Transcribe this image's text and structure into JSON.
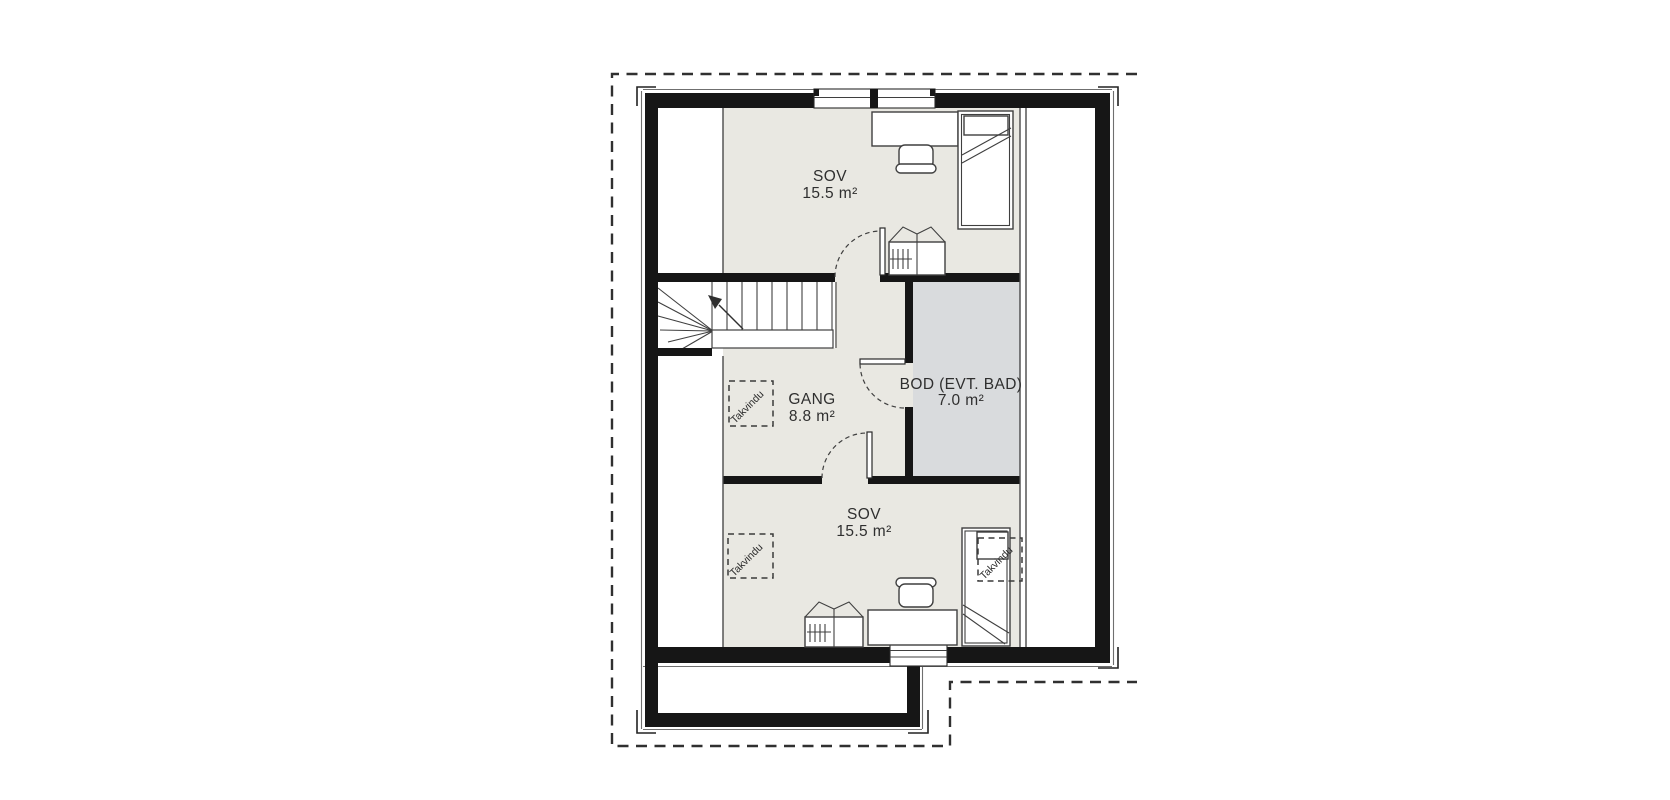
{
  "floorplan": {
    "rooms": [
      {
        "name": "SOV",
        "area": "15.5 m²"
      },
      {
        "name": "GANG",
        "area": "8.8 m²"
      },
      {
        "name": "BOD (EVT. BAD)",
        "area": "7.0 m²"
      },
      {
        "name": "SOV",
        "area": "15.5 m²"
      }
    ],
    "skylight_label": "Takvindu",
    "colors": {
      "wall": "#161616",
      "room_fill": "#e9e8e2",
      "storage_fill": "#d9dbdd",
      "line": "#3f3f3f",
      "roof_outline": "#303030"
    }
  }
}
